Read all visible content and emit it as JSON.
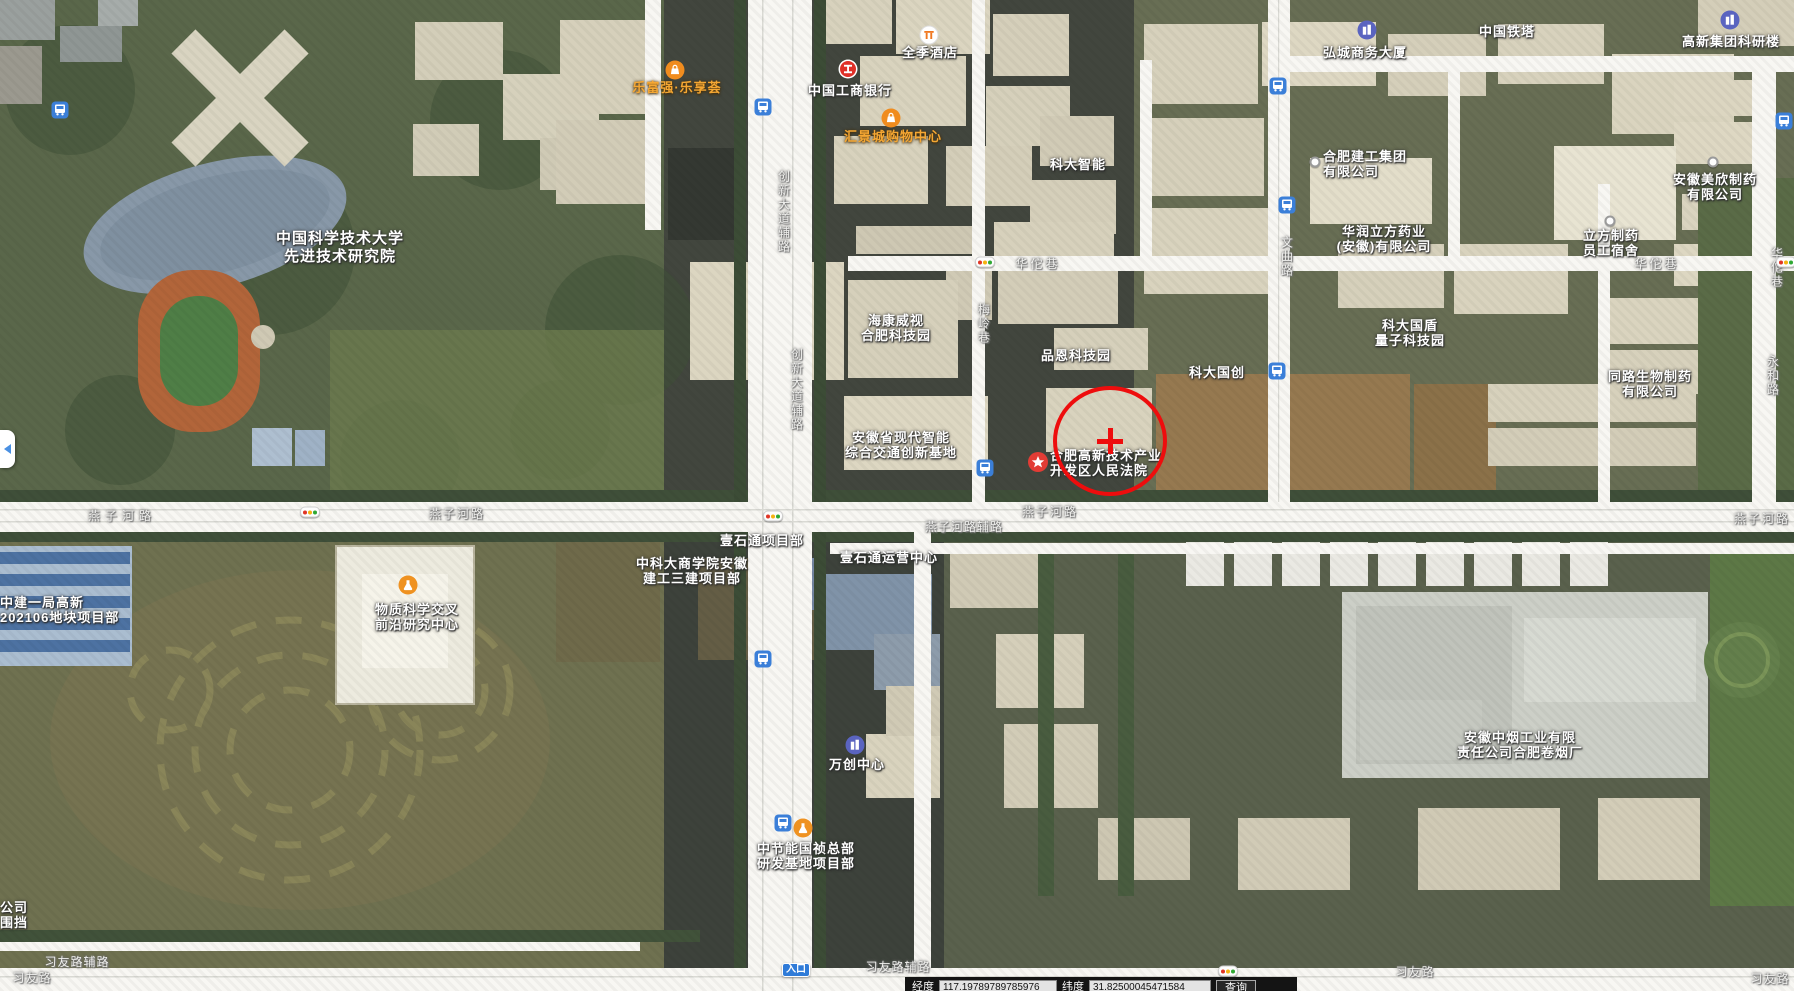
{
  "bottom_bar": {
    "lng_label": "经度",
    "lng_value": "117.19789789785976",
    "lat_label": "纬度",
    "lat_value": "31.82500045471584",
    "search_label": "查询"
  },
  "map": {
    "annotation": {
      "cx": 1110,
      "cy": 441,
      "rx": 53,
      "ry": 51,
      "cross_len": 26,
      "cross_w": 5
    },
    "labels": [
      {
        "name": "ustc-advanced-institute",
        "lines": [
          "中国科学技术大学",
          "先进技术研究院"
        ],
        "x": 340,
        "y": 230,
        "align": "center",
        "cls": "big"
      },
      {
        "name": "lefuqiang-lexianghui",
        "lines": [
          "乐富强·乐享荟"
        ],
        "x": 677,
        "y": 80,
        "align": "center",
        "cls": "orange"
      },
      {
        "name": "huijingcheng-mall",
        "lines": [
          "汇景城购物中心"
        ],
        "x": 893,
        "y": 129,
        "align": "center",
        "cls": "orange"
      },
      {
        "name": "icbc-bank",
        "lines": [
          "中国工商银行"
        ],
        "x": 850,
        "y": 83,
        "align": "center"
      },
      {
        "name": "quanji-hotel",
        "lines": [
          "全季酒店"
        ],
        "x": 930,
        "y": 45,
        "align": "center"
      },
      {
        "name": "hongcheng-business-tower",
        "lines": [
          "弘城商务大厦"
        ],
        "x": 1365,
        "y": 45,
        "align": "center"
      },
      {
        "name": "china-tower",
        "lines": [
          "中国铁塔"
        ],
        "x": 1507,
        "y": 24,
        "align": "center"
      },
      {
        "name": "gaoxin-group-research",
        "lines": [
          "高新集团科研楼"
        ],
        "x": 1731,
        "y": 34,
        "align": "center"
      },
      {
        "name": "keda-zhineng",
        "lines": [
          "科大智能"
        ],
        "x": 1078,
        "y": 157,
        "align": "center"
      },
      {
        "name": "hefei-jiangong-group",
        "lines": [
          "合肥建工集团",
          "有限公司"
        ],
        "x": 1323,
        "y": 149,
        "align": "left"
      },
      {
        "name": "huarun-lifang-pharma",
        "lines": [
          "华润立方药业",
          "(安徽)有限公司"
        ],
        "x": 1384,
        "y": 224,
        "align": "center"
      },
      {
        "name": "meixin-pharma",
        "lines": [
          "安徽美欣制药",
          "有限公司"
        ],
        "x": 1715,
        "y": 172,
        "align": "center"
      },
      {
        "name": "lifang-dorm",
        "lines": [
          "立方制药",
          "员工宿舍"
        ],
        "x": 1611,
        "y": 228,
        "align": "center"
      },
      {
        "name": "hikvision-hefei-park",
        "lines": [
          "海康威视",
          "合肥科技园"
        ],
        "x": 896,
        "y": 313,
        "align": "center"
      },
      {
        "name": "pinen-tech-park",
        "lines": [
          "品恩科技园"
        ],
        "x": 1076,
        "y": 348,
        "align": "center"
      },
      {
        "name": "keda-guochuang",
        "lines": [
          "科大国创"
        ],
        "x": 1217,
        "y": 365,
        "align": "center"
      },
      {
        "name": "keda-guodun-quantum",
        "lines": [
          "科大国盾",
          "量子科技园"
        ],
        "x": 1410,
        "y": 318,
        "align": "center"
      },
      {
        "name": "tonglu-bio-pharma",
        "lines": [
          "同路生物制药",
          "有限公司"
        ],
        "x": 1650,
        "y": 369,
        "align": "center"
      },
      {
        "name": "anhui-transport-base",
        "lines": [
          "安徽省现代智能",
          "综合交通创新基地"
        ],
        "x": 901,
        "y": 430,
        "align": "center"
      },
      {
        "name": "gaoxin-court",
        "lines": [
          "合肥高新技术产业",
          "开发区人民法院"
        ],
        "x": 1050,
        "y": 448,
        "align": "left"
      },
      {
        "name": "yishitong-project-dept",
        "lines": [
          "壹石通项目部"
        ],
        "x": 762,
        "y": 533,
        "align": "center"
      },
      {
        "name": "yishitong-operation-center",
        "lines": [
          "壹石通运营中心"
        ],
        "x": 889,
        "y": 550,
        "align": "center"
      },
      {
        "name": "zhongkeda-business-school",
        "lines": [
          "中科大商学院安徽",
          "建工三建项目部"
        ],
        "x": 692,
        "y": 556,
        "align": "center"
      },
      {
        "name": "material-science-center",
        "lines": [
          "物质科学交叉",
          "前沿研究中心"
        ],
        "x": 417,
        "y": 602,
        "align": "center"
      },
      {
        "name": "zhongjian-yiju-plot",
        "lines": [
          "中建一局高新",
          "202106地块项目部"
        ],
        "x": 0,
        "y": 595,
        "align": "left"
      },
      {
        "name": "anhui-tobacco-factory",
        "lines": [
          "安徽中烟工业有限",
          "责任公司合肥卷烟厂"
        ],
        "x": 1520,
        "y": 730,
        "align": "center"
      },
      {
        "name": "wanchuang-center",
        "lines": [
          "万创中心"
        ],
        "x": 857,
        "y": 757,
        "align": "center"
      },
      {
        "name": "zhongjieneng-guozhen",
        "lines": [
          "中节能国祯总部",
          "研发基地项目部"
        ],
        "x": 806,
        "y": 841,
        "align": "center"
      },
      {
        "name": "edge-partial-label",
        "lines": [
          "公司",
          "围挡"
        ],
        "x": 0,
        "y": 900,
        "align": "left"
      },
      {
        "name": "entrance-pill",
        "lines": [
          "入口"
        ],
        "x": 796,
        "y": 963,
        "align": "center",
        "cls": "pill"
      }
    ],
    "road_labels": [
      {
        "text": "燕子河路",
        "x": 122,
        "y": 510,
        "ls": 5
      },
      {
        "text": "燕子河路",
        "x": 457,
        "y": 508,
        "ls": 2
      },
      {
        "text": "燕子河路",
        "x": 1050,
        "y": 506,
        "ls": 2
      },
      {
        "text": "燕子河路",
        "x": 1762,
        "y": 513,
        "ls": 2
      },
      {
        "text": "燕子河路辅路",
        "x": 964,
        "y": 521,
        "ls": 1
      },
      {
        "text": "习友路辅路",
        "x": 77,
        "y": 956,
        "ls": 1
      },
      {
        "text": "习友路",
        "x": 32,
        "y": 972,
        "ls": 1
      },
      {
        "text": "习友路辅路",
        "x": 898,
        "y": 961,
        "ls": 1
      },
      {
        "text": "习友路",
        "x": 1415,
        "y": 966,
        "ls": 1
      },
      {
        "text": "习友路",
        "x": 1770,
        "y": 973,
        "ls": 1
      },
      {
        "text": "华佗巷",
        "x": 1038,
        "y": 258,
        "ls": 3
      },
      {
        "text": "华佗巷",
        "x": 1657,
        "y": 258,
        "ls": 3
      },
      {
        "text": "梅岭巷",
        "x": 983,
        "y": 303,
        "v": true
      },
      {
        "text": "文曲路",
        "x": 1286,
        "y": 236,
        "v": true
      },
      {
        "text": "永和路",
        "x": 1772,
        "y": 355,
        "v": true
      },
      {
        "text": "华佗巷",
        "x": 1776,
        "y": 247,
        "v": true
      },
      {
        "text": "创新大道辅路",
        "x": 783,
        "y": 170,
        "v": true
      },
      {
        "text": "创新大道辅路",
        "x": 796,
        "y": 348,
        "v": true
      }
    ],
    "icons": [
      {
        "type": "bus",
        "x": 60,
        "y": 110
      },
      {
        "type": "bus",
        "x": 763,
        "y": 107
      },
      {
        "type": "bus",
        "x": 1278,
        "y": 86
      },
      {
        "type": "bus",
        "x": 1784,
        "y": 121
      },
      {
        "type": "bus",
        "x": 1287,
        "y": 205
      },
      {
        "type": "bus",
        "x": 1277,
        "y": 371
      },
      {
        "type": "bus",
        "x": 985,
        "y": 468
      },
      {
        "type": "bus",
        "x": 763,
        "y": 659
      },
      {
        "type": "bus",
        "x": 783,
        "y": 823
      },
      {
        "type": "traffic",
        "x": 985,
        "y": 262
      },
      {
        "type": "traffic",
        "x": 310,
        "y": 512
      },
      {
        "type": "traffic",
        "x": 773,
        "y": 516
      },
      {
        "type": "traffic",
        "x": 1786,
        "y": 262
      },
      {
        "type": "traffic",
        "x": 1228,
        "y": 971
      },
      {
        "type": "bag",
        "x": 675,
        "y": 70
      },
      {
        "type": "bag",
        "x": 891,
        "y": 118
      },
      {
        "type": "icbc",
        "x": 848,
        "y": 69
      },
      {
        "type": "hotel",
        "x": 929,
        "y": 35
      },
      {
        "type": "building",
        "x": 1367,
        "y": 30
      },
      {
        "type": "building",
        "x": 1730,
        "y": 20
      },
      {
        "type": "building",
        "x": 855,
        "y": 745
      },
      {
        "type": "star",
        "x": 1038,
        "y": 462
      },
      {
        "type": "flask",
        "x": 408,
        "y": 585
      },
      {
        "type": "flask",
        "x": 803,
        "y": 828
      },
      {
        "type": "dot",
        "x": 1315,
        "y": 162
      },
      {
        "type": "dot",
        "x": 1610,
        "y": 221
      },
      {
        "type": "dot",
        "x": 1713,
        "y": 162
      }
    ]
  }
}
